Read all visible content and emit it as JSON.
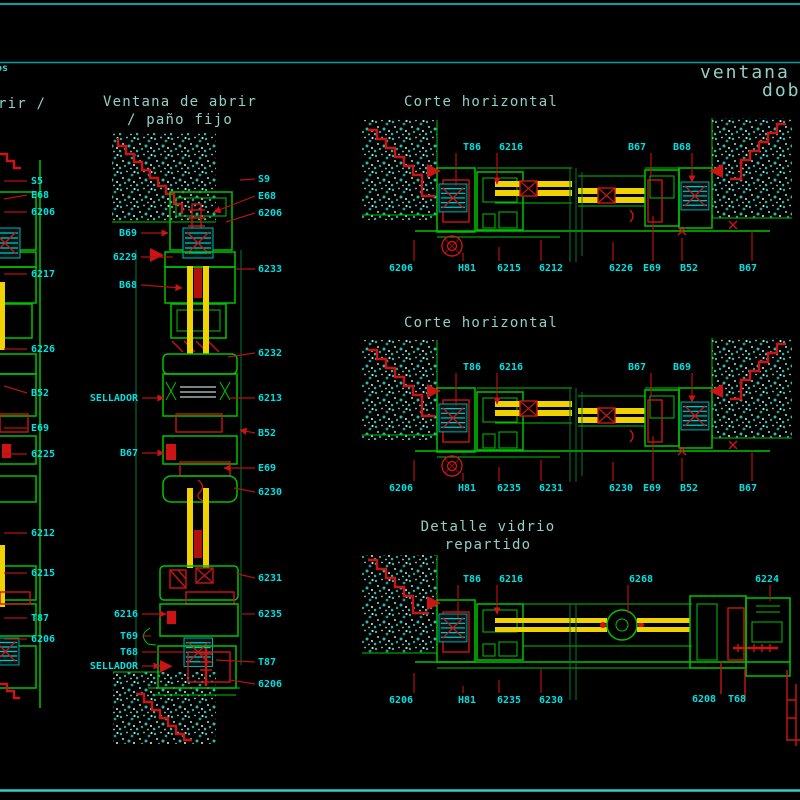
{
  "window": {
    "width": 800,
    "height": 800,
    "background": "#000000"
  },
  "palette": {
    "line_green": "#00C400",
    "detail_red": "#CC1414",
    "glass_yellow": "#EFD200",
    "label_cyan": "#00E0E0",
    "title_teal": "#8FD0C8",
    "border_teal": "#00A2A2",
    "hatch_teal": "#2FB8AC"
  },
  "titles": {
    "corner_fragment": "os",
    "left_partial": "rir /",
    "ventana_1": "Ventana de abrir",
    "ventana_2": "/ paño fijo",
    "corte_1": "Corte horizontal",
    "corte_2": "Corte horizontal",
    "detalle_1": "Detalle vidrio",
    "detalle_2": "repartido",
    "right_1": "ventana d",
    "right_2": "dob"
  },
  "labels": [
    {
      "t": "S5",
      "x": 31,
      "y": 181,
      "a": "start",
      "lead": [
        [
          4,
          181
        ],
        [
          27,
          181
        ]
      ]
    },
    {
      "t": "E68",
      "x": 31,
      "y": 195,
      "a": "start",
      "lead": [
        [
          4,
          199
        ],
        [
          27,
          195
        ]
      ]
    },
    {
      "t": "6206",
      "x": 31,
      "y": 212,
      "a": "start",
      "lead": [
        [
          4,
          212
        ],
        [
          27,
          212
        ]
      ]
    },
    {
      "t": "6217",
      "x": 31,
      "y": 274,
      "a": "start",
      "lead": [
        [
          4,
          274
        ],
        [
          27,
          274
        ]
      ]
    },
    {
      "t": "6226",
      "x": 31,
      "y": 349,
      "a": "start",
      "lead": [
        [
          4,
          349
        ],
        [
          27,
          349
        ]
      ]
    },
    {
      "t": "B52",
      "x": 31,
      "y": 393,
      "a": "start",
      "lead": [
        [
          4,
          386
        ],
        [
          27,
          393
        ]
      ]
    },
    {
      "t": "E69",
      "x": 31,
      "y": 428,
      "a": "start",
      "lead": [
        [
          4,
          428
        ],
        [
          27,
          428
        ]
      ]
    },
    {
      "t": "6225",
      "x": 31,
      "y": 454,
      "a": "start",
      "lead": [
        [
          4,
          454
        ],
        [
          27,
          454
        ]
      ]
    },
    {
      "t": "6212",
      "x": 31,
      "y": 533,
      "a": "start",
      "lead": [
        [
          4,
          533
        ],
        [
          27,
          533
        ]
      ]
    },
    {
      "t": "6215",
      "x": 31,
      "y": 573,
      "a": "start",
      "lead": [
        [
          4,
          573
        ],
        [
          27,
          573
        ]
      ]
    },
    {
      "t": "T87",
      "x": 31,
      "y": 618,
      "a": "start",
      "lead": [
        [
          4,
          618
        ],
        [
          27,
          618
        ]
      ]
    },
    {
      "t": "6206",
      "x": 31,
      "y": 639,
      "a": "start",
      "lead": [
        [
          4,
          639
        ],
        [
          27,
          639
        ]
      ]
    },
    {
      "t": "B69",
      "x": 137,
      "y": 233,
      "a": "end",
      "lead": [
        [
          141,
          233
        ],
        [
          168,
          233
        ]
      ],
      "arrow": true
    },
    {
      "t": "6229",
      "x": 137,
      "y": 257,
      "a": "end",
      "lead": [
        [
          141,
          257
        ],
        [
          173,
          257
        ]
      ]
    },
    {
      "t": "B68",
      "x": 137,
      "y": 285,
      "a": "end",
      "lead": [
        [
          141,
          285
        ],
        [
          182,
          288
        ]
      ],
      "arrow": true
    },
    {
      "t": "SELLADOR",
      "x": 138,
      "y": 398,
      "a": "end",
      "lead": [
        [
          142,
          398
        ],
        [
          164,
          398
        ]
      ],
      "arrow": true
    },
    {
      "t": "B67",
      "x": 138,
      "y": 453,
      "a": "end",
      "lead": [
        [
          142,
          453
        ],
        [
          164,
          453
        ]
      ],
      "arrow": true
    },
    {
      "t": "6216",
      "x": 138,
      "y": 614,
      "a": "end",
      "lead": [
        [
          142,
          614
        ],
        [
          166,
          614
        ]
      ],
      "arrow": true
    },
    {
      "t": "T69",
      "x": 138,
      "y": 636,
      "a": "end",
      "lead": [
        [
          142,
          636
        ],
        [
          151,
          636
        ]
      ]
    },
    {
      "t": "T68",
      "x": 138,
      "y": 652,
      "a": "end",
      "lead": [
        [
          142,
          652
        ],
        [
          184,
          652
        ]
      ]
    },
    {
      "t": "SELLADOR",
      "x": 138,
      "y": 666,
      "a": "end",
      "lead": [
        [
          142,
          666
        ],
        [
          160,
          666
        ]
      ],
      "arrow": true
    },
    {
      "t": "S9",
      "x": 258,
      "y": 179,
      "a": "start",
      "lead": [
        [
          240,
          180
        ],
        [
          255,
          179
        ]
      ]
    },
    {
      "t": "E68",
      "x": 258,
      "y": 196,
      "a": "start",
      "lead": [
        [
          255,
          196
        ],
        [
          214,
          212
        ]
      ],
      "arrow": true
    },
    {
      "t": "6206",
      "x": 258,
      "y": 213,
      "a": "start",
      "lead": [
        [
          255,
          213
        ],
        [
          226,
          222
        ]
      ]
    },
    {
      "t": "6233",
      "x": 258,
      "y": 269,
      "a": "start",
      "lead": [
        [
          236,
          269
        ],
        [
          255,
          269
        ]
      ]
    },
    {
      "t": "6232",
      "x": 258,
      "y": 353,
      "a": "start",
      "lead": [
        [
          228,
          357
        ],
        [
          255,
          353
        ]
      ]
    },
    {
      "t": "6213",
      "x": 258,
      "y": 398,
      "a": "start",
      "lead": [
        [
          230,
          398
        ],
        [
          255,
          398
        ]
      ]
    },
    {
      "t": "B52",
      "x": 258,
      "y": 433,
      "a": "start",
      "lead": [
        [
          255,
          433
        ],
        [
          240,
          430
        ]
      ],
      "arrow": true
    },
    {
      "t": "E69",
      "x": 258,
      "y": 468,
      "a": "start",
      "lead": [
        [
          255,
          468
        ],
        [
          224,
          468
        ]
      ],
      "arrow": true
    },
    {
      "t": "6230",
      "x": 258,
      "y": 492,
      "a": "start",
      "lead": [
        [
          234,
          488
        ],
        [
          255,
          492
        ]
      ]
    },
    {
      "t": "6231",
      "x": 258,
      "y": 578,
      "a": "start",
      "lead": [
        [
          238,
          574
        ],
        [
          255,
          578
        ]
      ]
    },
    {
      "t": "6235",
      "x": 258,
      "y": 614,
      "a": "start",
      "lead": [
        [
          242,
          614
        ],
        [
          255,
          614
        ]
      ]
    },
    {
      "t": "T87",
      "x": 258,
      "y": 662,
      "a": "start",
      "lead": [
        [
          216,
          660
        ],
        [
          255,
          662
        ]
      ]
    },
    {
      "t": "6206",
      "x": 258,
      "y": 684,
      "a": "start",
      "lead": [
        [
          230,
          680
        ],
        [
          255,
          684
        ]
      ]
    },
    {
      "t": "T86",
      "x": 472,
      "y": 147,
      "a": "middle",
      "lead": [
        [
          456,
          153
        ],
        [
          456,
          186
        ]
      ]
    },
    {
      "t": "6216",
      "x": 511,
      "y": 147,
      "a": "middle",
      "lead": [
        [
          497,
          153
        ],
        [
          497,
          184
        ]
      ],
      "arrow": true
    },
    {
      "t": "B67",
      "x": 637,
      "y": 147,
      "a": "middle",
      "lead": [
        [
          651,
          153
        ],
        [
          651,
          176
        ]
      ]
    },
    {
      "t": "B68",
      "x": 682,
      "y": 147,
      "a": "middle",
      "lead": [
        [
          692,
          153
        ],
        [
          692,
          182
        ]
      ],
      "arrow": true
    },
    {
      "t": "6206",
      "x": 401,
      "y": 268,
      "a": "middle",
      "lead": [
        [
          414,
          261
        ],
        [
          414,
          240
        ]
      ]
    },
    {
      "t": "H81",
      "x": 467,
      "y": 268,
      "a": "middle",
      "lead": [
        [
          463,
          261
        ],
        [
          463,
          253
        ]
      ]
    },
    {
      "t": "6215",
      "x": 509,
      "y": 268,
      "a": "middle",
      "lead": [
        [
          499,
          261
        ],
        [
          499,
          247
        ]
      ]
    },
    {
      "t": "6212",
      "x": 551,
      "y": 268,
      "a": "middle",
      "lead": [
        [
          541,
          261
        ],
        [
          541,
          240
        ]
      ]
    },
    {
      "t": "6226",
      "x": 621,
      "y": 268,
      "a": "middle",
      "lead": [
        [
          613,
          261
        ],
        [
          613,
          242
        ]
      ]
    },
    {
      "t": "E69",
      "x": 652,
      "y": 268,
      "a": "middle",
      "lead": [
        [
          653,
          261
        ],
        [
          653,
          216
        ]
      ]
    },
    {
      "t": "B52",
      "x": 689,
      "y": 268,
      "a": "middle",
      "lead": [
        [
          682,
          261
        ],
        [
          682,
          238
        ]
      ]
    },
    {
      "t": "B67",
      "x": 748,
      "y": 268,
      "a": "middle",
      "lead": [
        [
          752,
          261
        ],
        [
          752,
          231
        ]
      ]
    },
    {
      "t": "T86",
      "x": 472,
      "y": 367,
      "a": "middle",
      "lead": [
        [
          456,
          373
        ],
        [
          456,
          406
        ]
      ]
    },
    {
      "t": "6216",
      "x": 511,
      "y": 367,
      "a": "middle",
      "lead": [
        [
          497,
          373
        ],
        [
          497,
          404
        ]
      ],
      "arrow": true
    },
    {
      "t": "B67",
      "x": 637,
      "y": 367,
      "a": "middle",
      "lead": [
        [
          651,
          373
        ],
        [
          651,
          396
        ]
      ]
    },
    {
      "t": "B69",
      "x": 682,
      "y": 367,
      "a": "middle",
      "lead": [
        [
          692,
          373
        ],
        [
          692,
          402
        ]
      ],
      "arrow": true
    },
    {
      "t": "6206",
      "x": 401,
      "y": 488,
      "a": "middle",
      "lead": [
        [
          414,
          481
        ],
        [
          414,
          460
        ]
      ]
    },
    {
      "t": "H81",
      "x": 467,
      "y": 488,
      "a": "middle",
      "lead": [
        [
          463,
          481
        ],
        [
          463,
          473
        ]
      ]
    },
    {
      "t": "6235",
      "x": 509,
      "y": 488,
      "a": "middle",
      "lead": [
        [
          499,
          481
        ],
        [
          499,
          467
        ]
      ]
    },
    {
      "t": "6231",
      "x": 551,
      "y": 488,
      "a": "middle",
      "lead": [
        [
          541,
          481
        ],
        [
          541,
          460
        ]
      ]
    },
    {
      "t": "6230",
      "x": 621,
      "y": 488,
      "a": "middle",
      "lead": [
        [
          613,
          481
        ],
        [
          613,
          462
        ]
      ]
    },
    {
      "t": "E69",
      "x": 652,
      "y": 488,
      "a": "middle",
      "lead": [
        [
          653,
          481
        ],
        [
          653,
          436
        ]
      ]
    },
    {
      "t": "B52",
      "x": 689,
      "y": 488,
      "a": "middle",
      "lead": [
        [
          682,
          481
        ],
        [
          682,
          458
        ]
      ]
    },
    {
      "t": "B67",
      "x": 748,
      "y": 488,
      "a": "middle",
      "lead": [
        [
          752,
          481
        ],
        [
          752,
          451
        ]
      ]
    },
    {
      "t": "T86",
      "x": 472,
      "y": 579,
      "a": "middle",
      "lead": [
        [
          458,
          585
        ],
        [
          458,
          618
        ]
      ]
    },
    {
      "t": "6216",
      "x": 511,
      "y": 579,
      "a": "middle",
      "lead": [
        [
          497,
          585
        ],
        [
          497,
          614
        ]
      ],
      "arrow": true
    },
    {
      "t": "6268",
      "x": 641,
      "y": 579,
      "a": "middle",
      "lead": [
        [
          628,
          585
        ],
        [
          628,
          613
        ]
      ]
    },
    {
      "t": "6224",
      "x": 767,
      "y": 579,
      "a": "middle",
      "lead": [
        [
          770,
          585
        ],
        [
          770,
          601
        ]
      ]
    },
    {
      "t": "6206",
      "x": 401,
      "y": 700,
      "a": "middle",
      "lead": [
        [
          414,
          693
        ],
        [
          414,
          673
        ]
      ]
    },
    {
      "t": "H81",
      "x": 467,
      "y": 700,
      "a": "middle",
      "lead": [
        [
          463,
          693
        ],
        [
          463,
          686
        ]
      ]
    },
    {
      "t": "6235",
      "x": 509,
      "y": 700,
      "a": "middle",
      "lead": [
        [
          499,
          693
        ],
        [
          499,
          680
        ]
      ]
    },
    {
      "t": "6230",
      "x": 551,
      "y": 700,
      "a": "middle",
      "lead": [
        [
          541,
          693
        ],
        [
          541,
          669
        ]
      ]
    },
    {
      "t": "6208",
      "x": 704,
      "y": 699,
      "a": "middle",
      "lead": [
        [
          721,
          692
        ],
        [
          721,
          669
        ]
      ]
    },
    {
      "t": "T68",
      "x": 737,
      "y": 699,
      "a": "middle",
      "lead": null
    }
  ]
}
